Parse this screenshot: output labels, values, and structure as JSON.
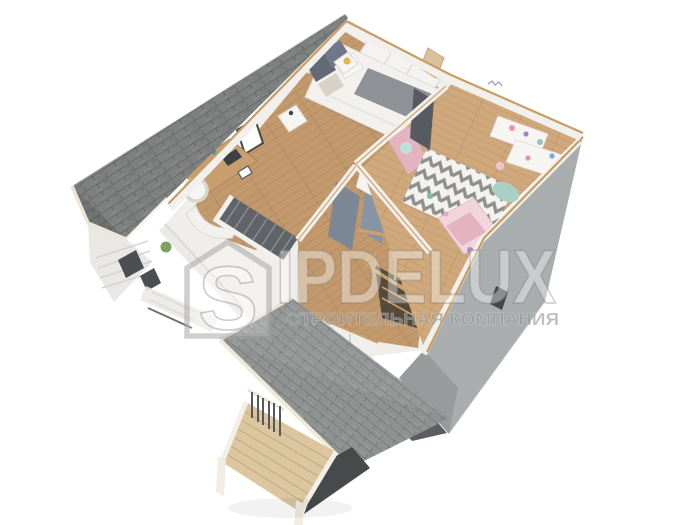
{
  "watermark": {
    "brand": "SIPDELUX",
    "logo_letter": "S",
    "brand_after_logo": "IPDELUX",
    "tagline": "СТРОИТЕЛЬНАЯ КОМПАНИЯ"
  },
  "colors": {
    "background": "#ffffff",
    "roof": "#7e8180",
    "porch_roof": "#8e9291",
    "fascia": "#ece5d6",
    "sip_trim": "#c79d63",
    "wall_white": "#f1f0ec",
    "wall_cream": "#e0dacb",
    "wall_gray": "#a9adae",
    "floor_wood": "#c2996c",
    "floor_wood_light": "#cfa97c",
    "deck_wood": "#dcc69f",
    "stair_dark": "#606468",
    "door_gray_blue": "#7d8897",
    "door_gray_blue_light": "#8794a3",
    "bed_white": "#f2f1ee",
    "bed_runner": "#8e9195",
    "pillow_dark": "#636a76",
    "kids_pink": "#e3b3c1",
    "kids_bed_pink": "#f0d6dc",
    "rug_base": "#f3f2ef",
    "rug_zigzag": "#8f8f8d",
    "mint": "#abcfc5",
    "accent_yellow": "#e6b54d",
    "plant_green": "#7ca35f",
    "shadow": "#3e4144",
    "watermark_fill": "rgba(255,255,255,0.38)",
    "tagline_color": "rgba(150,150,150,0.62)"
  }
}
